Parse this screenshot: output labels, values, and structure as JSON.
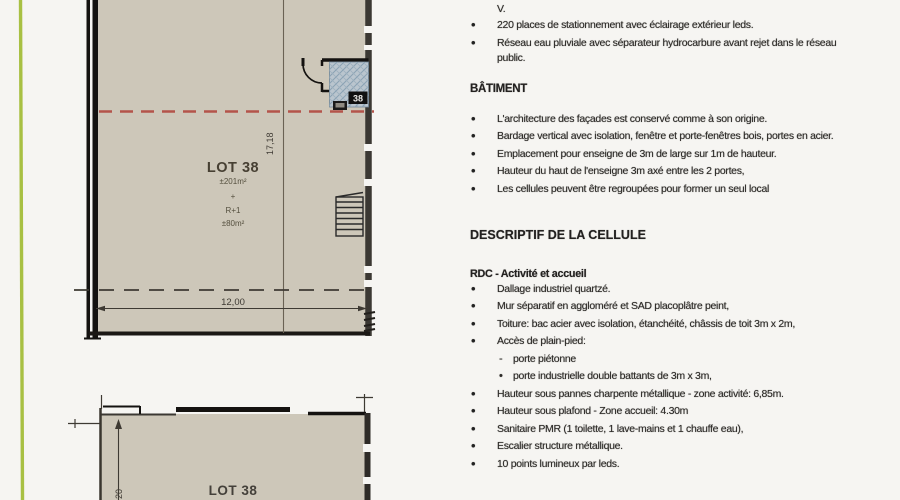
{
  "plan_top": {
    "lot_title": "LOT 38",
    "area_main": "±201m²",
    "plus_sign": "+",
    "level_label": "R+1",
    "area_upper": "±80m²",
    "dim_height": "17,18",
    "dim_width": "12,00",
    "cell_number": "38"
  },
  "plan_bottom": {
    "lot_title": "LOT 38",
    "dim_partial": "20"
  },
  "notes": {
    "continuation": "V.",
    "site_bullets": [
      "220 places de stationnement avec éclairage extérieur leds.",
      "Réseau eau pluviale avec séparateur hydrocarbure avant rejet dans le réseau public."
    ],
    "batiment_heading": "BÂTIMENT",
    "batiment_bullets": [
      "L'architecture des façades est conservé comme à  son origine.",
      "Bardage vertical avec isolation, fenêtre et porte-fenêtres bois, portes en acier.",
      "Emplacement pour enseigne de 3m de large sur 1m de hauteur.",
      "Hauteur du haut de l'enseigne 3m axé entre les 2 portes,",
      "Les cellules peuvent être regroupées pour former un seul local"
    ],
    "descriptif_heading": "DESCRIPTIF DE LA CELLULE",
    "rdc_heading": "RDC - Activité et accueil",
    "rdc_bullets_a": [
      "Dallage industriel quartzé.",
      "Mur séparatif en aggloméré et SAD placoplâtre peint,",
      "Toiture: bac acier avec isolation, étanchéité, châssis de toit 3m x 2m,",
      "Accès de plain-pied:"
    ],
    "acces_sub_items": [
      {
        "marker": "-",
        "text": "porte piétonne"
      },
      {
        "marker": "•",
        "text": "porte industrielle double battants de 3m x 3m,"
      }
    ],
    "rdc_bullets_b": [
      "Hauteur sous pannes charpente métallique - zone activité: 6,85m.",
      "Hauteur sous plafond - Zone accueil: 4.30m",
      "Sanitaire PMR (1 toilette, 1 lave-mains et 1 chauffe eau),",
      "Escalier structure métallique.",
      "10 points lumineux par leds."
    ]
  },
  "colors": {
    "page_bg": "#f6f5f2",
    "plan_fill": "#cdc7b9",
    "wall_black": "#161311",
    "wall_gray": "#3b3833",
    "red_axis": "#b4544a",
    "green_rule": "#a8c043",
    "hatch_fill": "#bac5ce",
    "hatch_line": "#8ba2b4",
    "dim_ink": "#3e3a33",
    "plan_text": "#474033"
  }
}
